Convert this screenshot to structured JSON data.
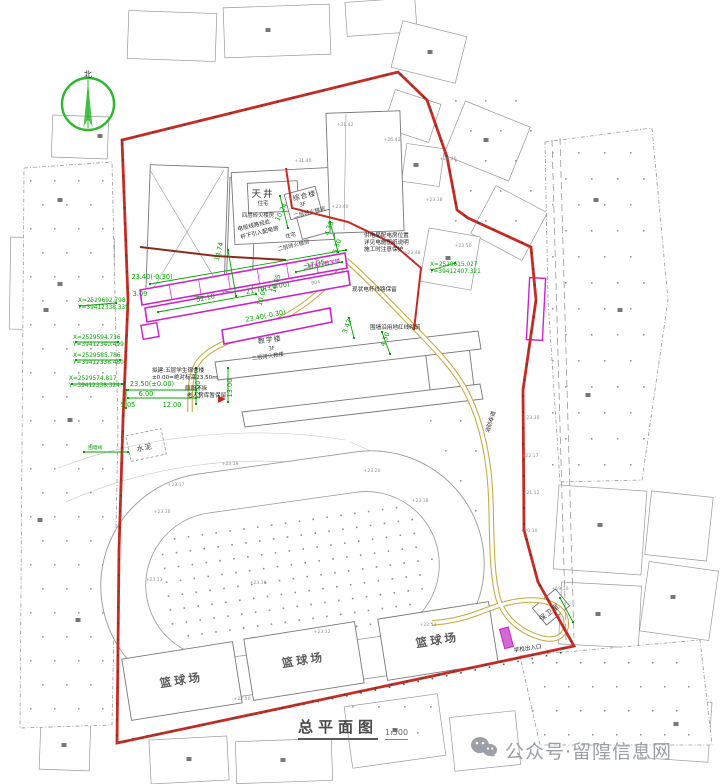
{
  "title": {
    "text": "总平面图",
    "scale": "1:500"
  },
  "watermark": {
    "text": "公众号·留隍信息网",
    "icon": "wechat-icon",
    "color": "#9aa0a6"
  },
  "compass": {
    "label": "北"
  },
  "colors": {
    "boundary_red": "#c92a22",
    "wall_maroon": "#8a2b1e",
    "proposed_magenta": "#cc22cc",
    "dimension_green": "#00a400",
    "road_yellow": "#c8a83e",
    "existing_gray": "#8a8a8a"
  },
  "annotations": [
    [
      "X=2529692.798",
      78,
      302,
      0,
      "coord"
    ],
    [
      "Y=39412338.335",
      78,
      309,
      0,
      "coord"
    ],
    [
      "X=2529594.716",
      73,
      339,
      0,
      "coord"
    ],
    [
      "Y=39412340.499",
      73,
      346,
      0,
      "coord"
    ],
    [
      "X=2529585.786",
      73,
      357,
      0,
      "coord"
    ],
    [
      "Y=39412338.480",
      73,
      364,
      0,
      "coord"
    ],
    [
      "X=2529574.817",
      69,
      380,
      0,
      "coord"
    ],
    [
      "Y=39412338.324",
      69,
      387,
      0,
      "coord"
    ],
    [
      "X=2529615.027",
      430,
      266,
      0,
      "coord"
    ],
    [
      "Y=39412407.321",
      430,
      273,
      0,
      "coord"
    ],
    [
      "23.40(-0.30)",
      152,
      279,
      0,
      "dim"
    ],
    [
      "3.09",
      140,
      296,
      0,
      "dim"
    ],
    [
      "52.10",
      206,
      300,
      -12,
      "dim"
    ],
    [
      "14.74",
      221,
      252,
      -76,
      "dim"
    ],
    [
      "10.24",
      283,
      213,
      -64,
      "dim"
    ],
    [
      "17.35",
      316,
      266,
      -11,
      "dim"
    ],
    [
      "21.70(±0.00)",
      268,
      290,
      -11,
      "dim"
    ],
    [
      "16.05",
      278,
      284,
      -74,
      "dim"
    ],
    [
      "10.05",
      264,
      297,
      -74,
      "dim"
    ],
    [
      "23.40(-0.30)",
      266,
      318,
      -11,
      "dim"
    ],
    [
      "4.38",
      331,
      229,
      -72,
      "dim"
    ],
    [
      "5.30",
      339,
      247,
      -72,
      "dim"
    ],
    [
      "3.42",
      349,
      327,
      -70,
      "dim"
    ],
    [
      "4.50",
      387,
      340,
      -70,
      "dim"
    ],
    [
      "23.50(±0.00)",
      152,
      386,
      0,
      "dim"
    ],
    [
      "6.00",
      146,
      396,
      0,
      "dim"
    ],
    [
      "5.05",
      128,
      407,
      0,
      "dim"
    ],
    [
      "12.00",
      172,
      407,
      0,
      "dim"
    ],
    [
      "12.00",
      200,
      390,
      -90,
      "dim"
    ],
    [
      "13.00",
      232,
      388,
      -90,
      "dim"
    ],
    [
      "围墙线",
      88,
      449,
      0,
      "gsm"
    ],
    [
      "电缆线路经此",
      238,
      231,
      -14,
      "note"
    ],
    [
      "杆下引入配电房",
      241,
      239,
      -14,
      "note"
    ],
    [
      "供电局配电房位置",
      364,
      237,
      0,
      "note"
    ],
    [
      "详见电施图纸说明",
      364,
      244,
      0,
      "note"
    ],
    [
      "施工时注意保护",
      364,
      251,
      0,
      "note"
    ],
    [
      "现状电杆线路保留",
      352,
      291,
      0,
      "note"
    ],
    [
      "围墙沿用地红线砌筑",
      370,
      329,
      0,
      "note"
    ],
    [
      "拟建:五层学生宿舍楼",
      152,
      372,
      0,
      "note"
    ],
    [
      "±0.00=绝对标高23.50m",
      152,
      379,
      0,
      "note"
    ],
    [
      "厕所不拆",
      185,
      390,
      0,
      "note"
    ],
    [
      "老人房库暂保留",
      187,
      397,
      0,
      "note"
    ],
    [
      "消防车道",
      489,
      433,
      -73,
      "note"
    ],
    [
      "学校出入口",
      514,
      652,
      -8,
      "note"
    ],
    [
      "天井",
      263,
      197,
      0,
      "bldg"
    ],
    [
      "综合楼",
      305,
      198,
      -14,
      "bldg2"
    ],
    [
      "教学楼",
      270,
      342,
      -8,
      "bldg2"
    ],
    [
      "保卫室",
      551,
      614,
      -38,
      "bldg2"
    ],
    [
      "水泥",
      145,
      450,
      -12,
      "bldg2"
    ],
    [
      "住宅",
      263,
      205,
      0,
      "bsub"
    ],
    [
      "四层砖火楼房",
      258,
      217,
      0,
      "bsub"
    ],
    [
      "3F",
      303,
      206,
      -14,
      "bsub"
    ],
    [
      "二层砖火楼房",
      310,
      214,
      -14,
      "bsub"
    ],
    [
      "住宅",
      291,
      237,
      -14,
      "bsub"
    ],
    [
      "二层砖火楼房",
      294,
      247,
      -14,
      "bsub"
    ],
    [
      "3F",
      272,
      350,
      -8,
      "bsub"
    ],
    [
      "二层砖火教楼",
      268,
      358,
      -8,
      "bsub"
    ],
    [
      "二层大厅教学楼",
      322,
      266,
      -11,
      "mag"
    ],
    [
      "B04",
      316,
      284,
      -11,
      "gray"
    ],
    [
      "篮球场",
      182,
      684,
      -9,
      "court"
    ],
    [
      "篮球场",
      304,
      664,
      -9,
      "court"
    ],
    [
      "篮球场",
      438,
      644,
      -9,
      "court"
    ],
    [
      "+31.42",
      345,
      126,
      0,
      "gray"
    ],
    [
      "+31.40",
      303,
      162,
      0,
      "gray"
    ],
    [
      "+26.42",
      392,
      141,
      0,
      "gray"
    ],
    [
      "+26.46",
      448,
      160,
      0,
      "gray"
    ],
    [
      "+23.18",
      434,
      201,
      0,
      "gray"
    ],
    [
      "+23.48",
      412,
      254,
      0,
      "gray"
    ],
    [
      "+23.50",
      463,
      247,
      0,
      "gray"
    ],
    [
      "+23.40",
      340,
      208,
      0,
      "gray"
    ],
    [
      "+23.19",
      230,
      465,
      0,
      "gray"
    ],
    [
      "+23.17",
      176,
      486,
      0,
      "gray"
    ],
    [
      "+23.16",
      162,
      513,
      0,
      "gray"
    ],
    [
      "+23.16",
      258,
      584,
      0,
      "gray"
    ],
    [
      "+23.13",
      154,
      581,
      0,
      "gray"
    ],
    [
      "+23.12",
      322,
      633,
      0,
      "gray"
    ],
    [
      "+23.18",
      420,
      502,
      0,
      "gray"
    ],
    [
      "+23.20",
      372,
      472,
      0,
      "gray"
    ],
    [
      "+23.30",
      531,
      419,
      0,
      "gray"
    ],
    [
      "+22.17",
      530,
      457,
      0,
      "gray"
    ],
    [
      "+21.12",
      531,
      494,
      0,
      "gray"
    ],
    [
      "+20.10",
      529,
      532,
      0,
      "gray"
    ],
    [
      "+22.52",
      428,
      626,
      0,
      "gray"
    ],
    [
      "+19.10",
      560,
      590,
      0,
      "gray"
    ],
    [
      "+22.50",
      242,
      700,
      0,
      "gray"
    ]
  ]
}
